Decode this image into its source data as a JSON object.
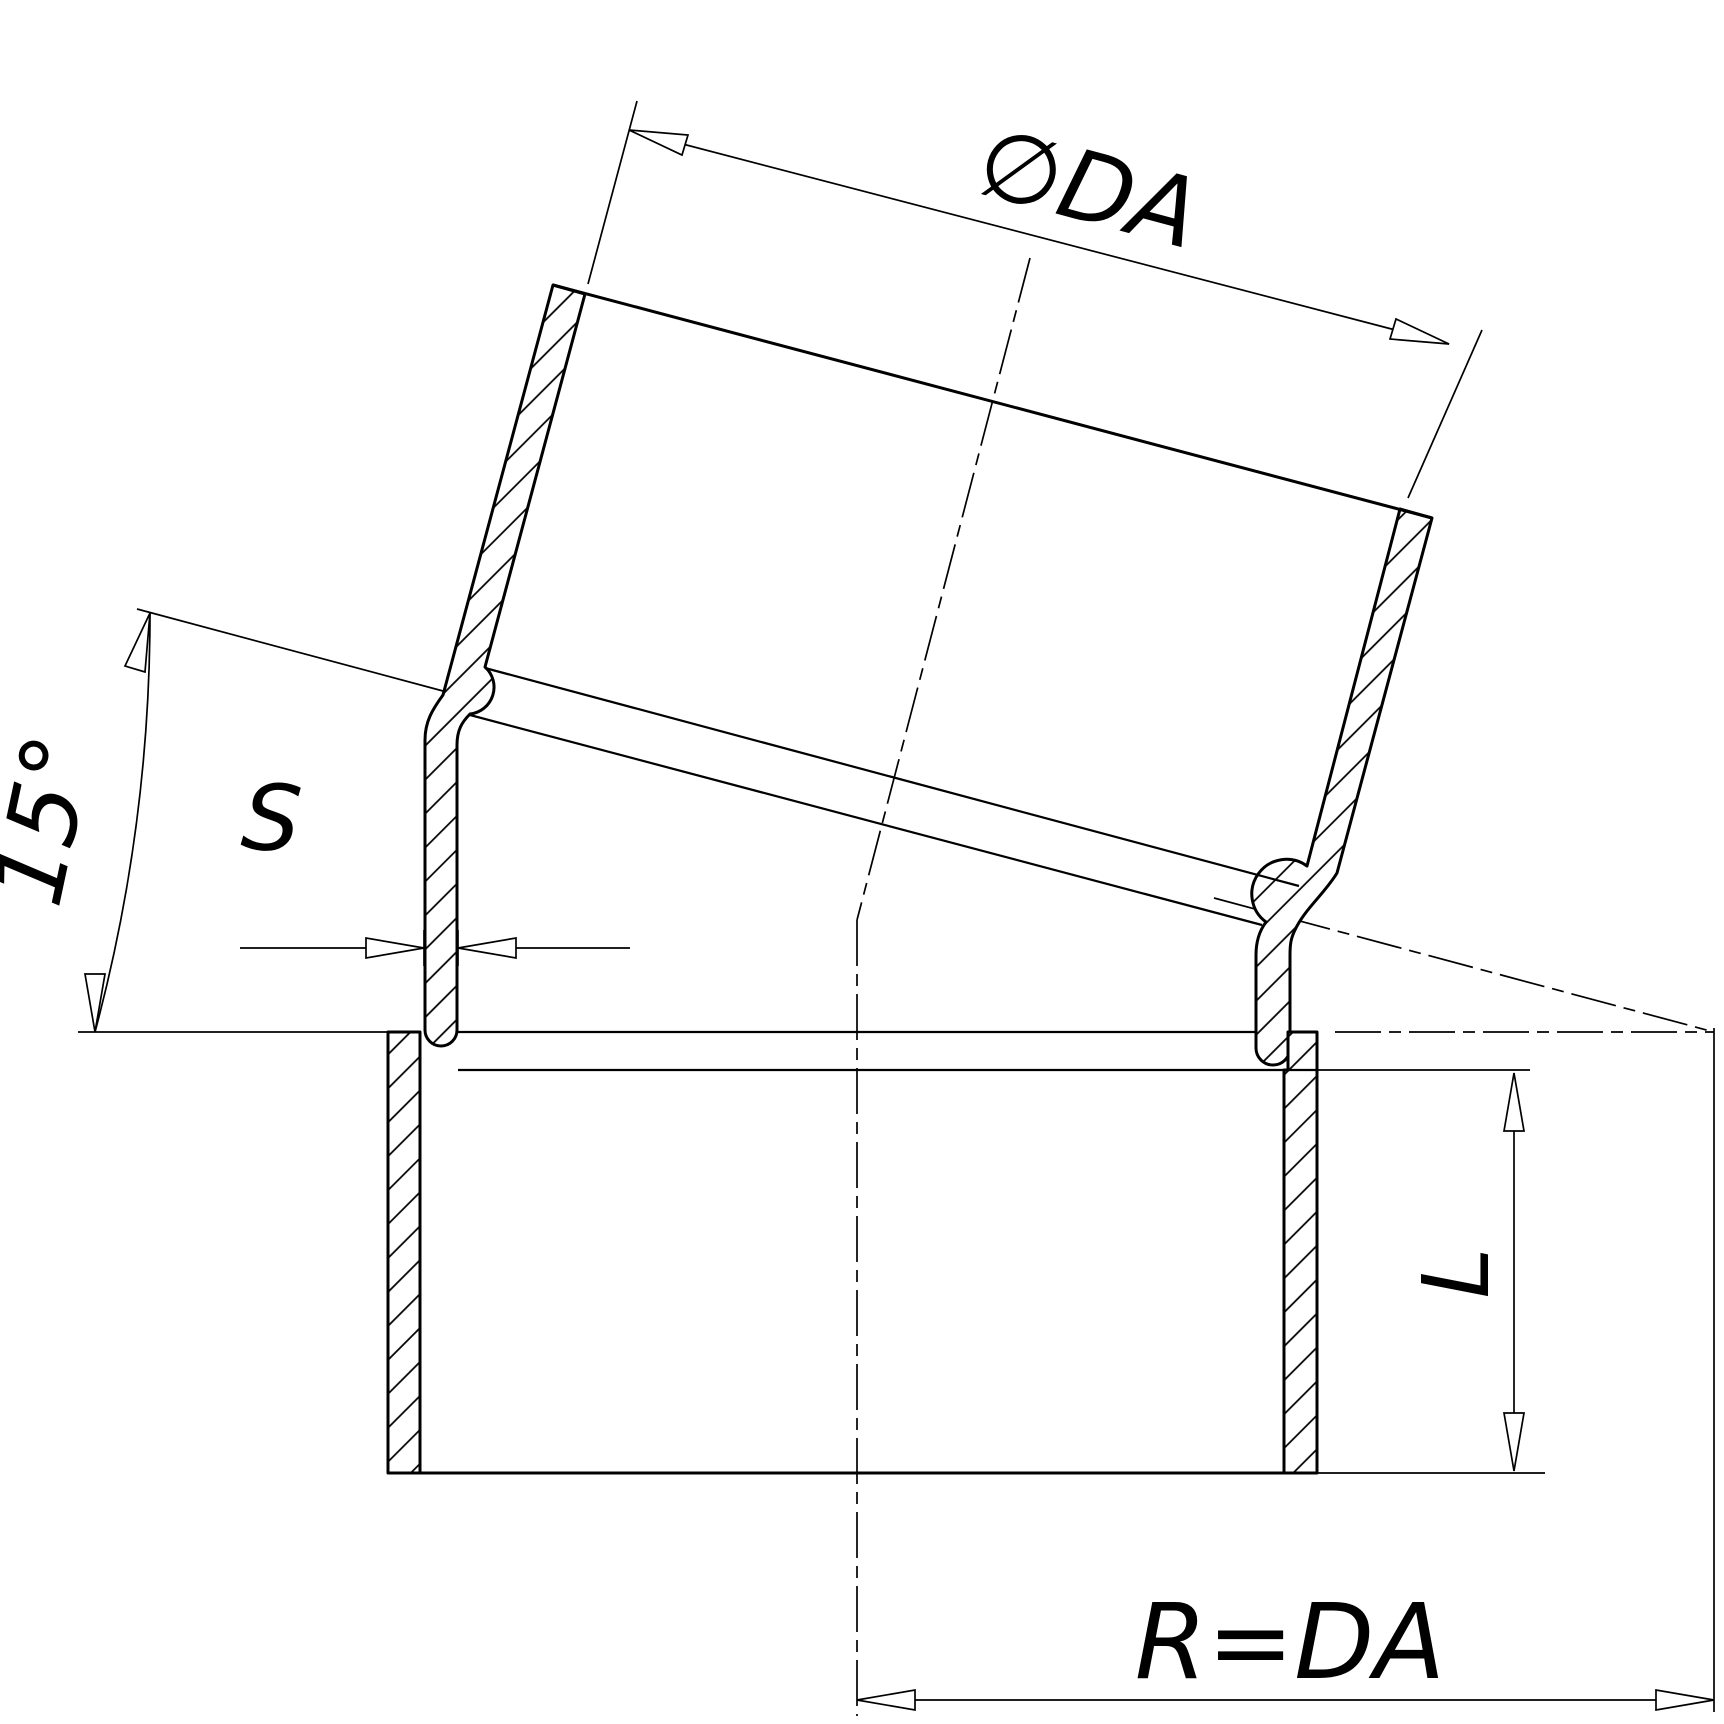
{
  "drawing": {
    "labels": {
      "diameter": "∅DA",
      "angle": "15°",
      "wall_thickness": "S",
      "insertion_length": "L",
      "radius": "R=DA"
    },
    "style": {
      "line_color": "#000000",
      "background": "#ffffff"
    }
  }
}
